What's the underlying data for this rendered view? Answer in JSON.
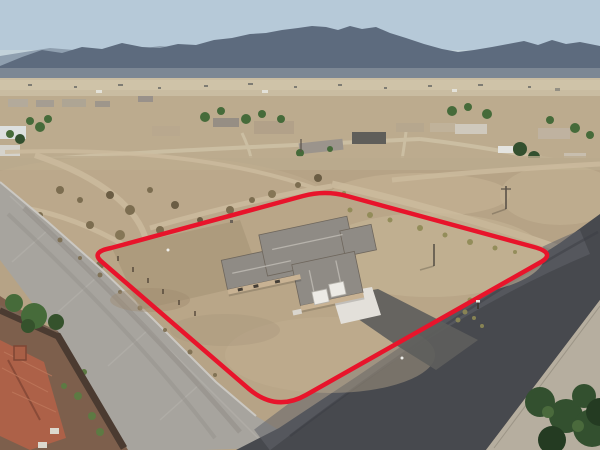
{
  "scene": {
    "description": "Aerial drone photo of a desert valley community: a single-story stucco home with gray hip roof and two-car garage sits centered on a large bare-dirt lot outlined by a red property-boundary line; a light concrete road runs along the lower-left, a dark asphalt road along the lower-right, scattered neighborhood homes and trees in the midground, open desert plain beyond, and a hazy blue mountain range under a pale sky on the horizon; a neighboring home with terracotta tile roof and dark perimeter wall occupies the bottom-left corner and dark green trees the bottom-right corner.",
    "elements": [
      "sky",
      "mountain-range",
      "desert-plain",
      "distant-buildings",
      "neighborhood-homes",
      "neighborhood-trees",
      "empty-dirt-lot",
      "dirt-tracks",
      "shrubs",
      "subject-property-lot",
      "red-property-boundary",
      "subject-house",
      "hip-roof",
      "garage-doors",
      "white-concrete-pad",
      "asphalt-driveway",
      "concrete-road",
      "asphalt-road",
      "gravel-shoulder",
      "corner-trees",
      "neighbor-tile-roof-house",
      "neighbor-perimeter-wall",
      "neighbor-gravel-yard",
      "utility-poles",
      "fence-posts",
      "weed-rows"
    ]
  },
  "boundary": {
    "color": "#e8142b",
    "stroke_width": 4.5,
    "shape": "rounded quadrilateral",
    "corners": [
      [
        91,
        253
      ],
      [
        325,
        191
      ],
      [
        556,
        253
      ],
      [
        276,
        412
      ]
    ]
  },
  "colors": {
    "sky": "#b6c9d8",
    "sky_horizon": "#c9d5dc",
    "mountain_far": "#8a99aa",
    "mountain_near": "#5d6b7e",
    "haze": "#b6bdbd",
    "plain_far": "#c9bca1",
    "plain_mid": "#bcab8e",
    "lot_dirt": "#b6a386",
    "subject_dirt": "#b9a688",
    "lot_dirt_light": "#c7b698",
    "lot_dirt_dark": "#a08d70",
    "road_concrete": "#a7a49e",
    "road_asphalt": "#47494e",
    "road_asphalt_worn": "#60626a",
    "road_shoulder": "#b6ae9f",
    "house_roof": "#8f8b85",
    "house_wall": "#c8b293",
    "garage_door": "#eceae5",
    "concrete_pad": "#e3e0da",
    "driveway_asphalt": "#5e5e5c",
    "neighbor_roof": "#ad6148",
    "neighbor_roof_dark": "#8a4b38",
    "neighbor_wall": "#4b3b31",
    "neighbor_gravel": "#7d5f4c",
    "tree_dark": "#33502f",
    "tree_mid": "#466b3a",
    "shrub_olive": "#7c6d50",
    "weed_olive": "#8f8a55",
    "white_building": "#dde0df",
    "pole_brown": "#5a5248"
  }
}
